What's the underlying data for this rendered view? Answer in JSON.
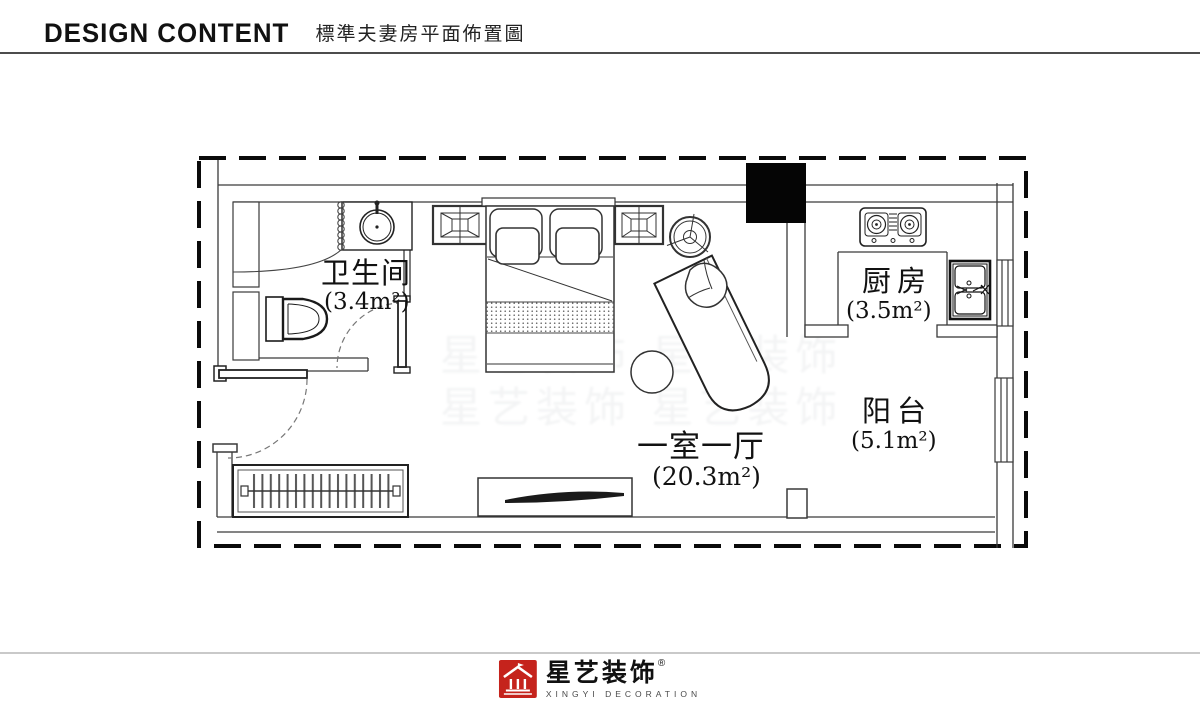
{
  "header": {
    "title_en": "DESIGN CONTENT",
    "subtitle_zh": "標準夫妻房平面佈置圖"
  },
  "plan": {
    "rooms": [
      {
        "id": "bathroom",
        "name": "卫生间",
        "area": "(3.4m²)"
      },
      {
        "id": "kitchen",
        "name": "厨房",
        "area": "(3.5m²)"
      },
      {
        "id": "living_bedroom",
        "name": "一室一厅",
        "area": "(20.3m²)"
      },
      {
        "id": "balcony",
        "name": "阳台",
        "area": "(5.1m²)"
      }
    ],
    "furniture_icons": [
      "double-bed",
      "pillow",
      "cushion",
      "nightstand",
      "ceiling-fan",
      "chaise-lounge",
      "stool",
      "tv-cabinet",
      "tv",
      "wardrobe-with-hangers",
      "entry-door",
      "bathroom-door",
      "toilet",
      "wash-basin",
      "shower-curtain",
      "gas-stove",
      "kitchen-sink",
      "structural-column",
      "window"
    ],
    "colors": {
      "wall": "#3a3a3a",
      "border": "#0a0a0a"
    }
  },
  "watermark": {
    "rows": [
      "星艺装饰 星艺装饰",
      "星艺装饰 星艺装饰"
    ]
  },
  "footer": {
    "brand_zh": "星艺装饰",
    "registered": "®",
    "brand_en": "XINGYI DECORATION",
    "brand_red": "#c5231c"
  }
}
